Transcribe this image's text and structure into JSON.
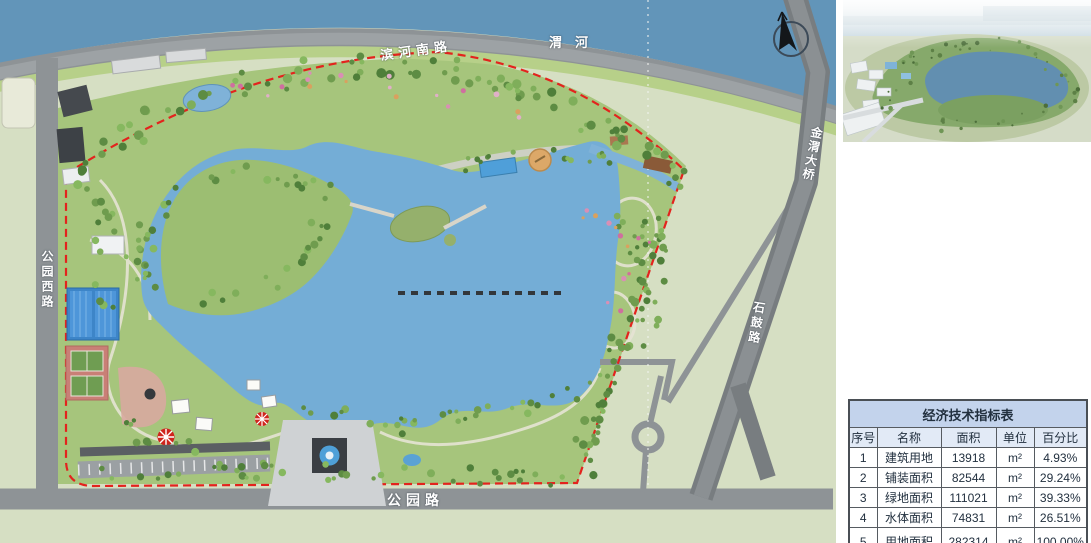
{
  "map": {
    "labels": {
      "riverside_road": "滨河南路",
      "river": "渭河",
      "bridge": "金渭大桥",
      "shigu_road": "石鼓路",
      "park_west_road": "公园西路",
      "park_road": "公园路"
    },
    "colors": {
      "river": "#6295b9",
      "lake": "#74add6",
      "park_green": "#a6c57c",
      "field_green": "#d6dfc3",
      "road_gray": "#8e9396",
      "boundary_red": "#e3231d"
    }
  },
  "table": {
    "title": "经济技术指标表",
    "headers": [
      "序号",
      "名称",
      "面积",
      "单位",
      "百分比"
    ],
    "rows": [
      [
        "1",
        "建筑用地",
        "13918",
        "m²",
        "4.93%"
      ],
      [
        "2",
        "铺装面积",
        "82544",
        "m²",
        "29.24%"
      ],
      [
        "3",
        "绿地面积",
        "111021",
        "m²",
        "39.33%"
      ],
      [
        "4",
        "水体面积",
        "74831",
        "m²",
        "26.51%"
      ],
      [
        "5",
        "用地面积",
        "282314",
        "m²",
        "100.00%"
      ]
    ]
  }
}
